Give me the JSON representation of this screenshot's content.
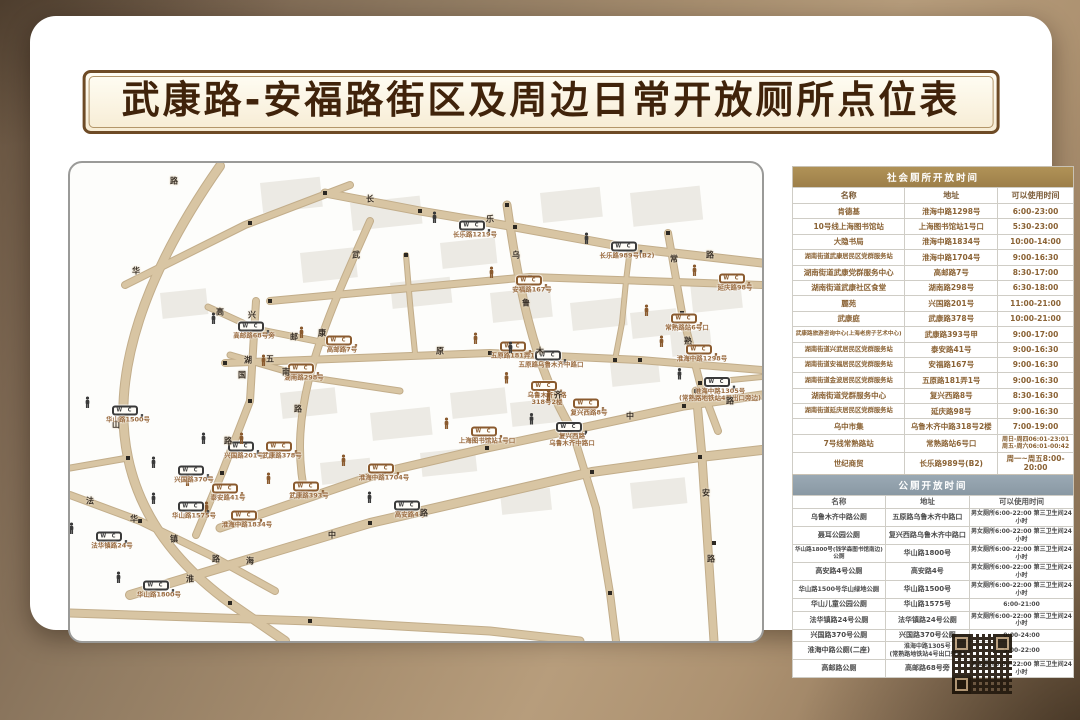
{
  "title": "武康路-安福路街区及周边日常开放厕所点位表",
  "colors": {
    "point_dark": "#3a3a3a",
    "point_brown": "#8a5a2e",
    "road_fill": "#d8c5a3",
    "road_edge": "#c2ad8a",
    "social_header_bg": "#a68a52",
    "public_header_bg": "#92a1ac"
  },
  "map": {
    "points": [
      {
        "label": "长乐路1219号",
        "x": 405,
        "y": 62,
        "color": "dark"
      },
      {
        "label": "长乐路989号(B2)",
        "x": 557,
        "y": 83,
        "color": "dark"
      },
      {
        "label": "安福路167号",
        "x": 462,
        "y": 117,
        "color": "brown"
      },
      {
        "label": "延庆路98号",
        "x": 665,
        "y": 115,
        "color": "brown"
      },
      {
        "label": "常熟路站6号口",
        "x": 617,
        "y": 155,
        "color": "brown"
      },
      {
        "label": "淮海中路1298号",
        "x": 632,
        "y": 186,
        "color": "brown"
      },
      {
        "label": "淮海中路1305号\n(常熟路地铁站4号出口旁边)",
        "x": 650,
        "y": 222,
        "color": "dark"
      },
      {
        "label": "高邮路68号旁",
        "x": 184,
        "y": 163,
        "color": "dark"
      },
      {
        "label": "高邮路7号",
        "x": 272,
        "y": 177,
        "color": "brown"
      },
      {
        "label": "湖南路298号",
        "x": 234,
        "y": 205,
        "color": "brown"
      },
      {
        "label": "华山路1500号",
        "x": 58,
        "y": 247,
        "color": "dark"
      },
      {
        "label": "五原路181弄1号",
        "x": 446,
        "y": 183,
        "color": "brown"
      },
      {
        "label": "五原路乌鲁木齐中路口",
        "x": 481,
        "y": 192,
        "color": "dark"
      },
      {
        "label": "乌鲁木齐中路\n318号2楼",
        "x": 477,
        "y": 226,
        "color": "brown"
      },
      {
        "label": "复兴西路8号",
        "x": 519,
        "y": 240,
        "color": "brown"
      },
      {
        "label": "上海图书馆站1号口",
        "x": 417,
        "y": 268,
        "color": "brown"
      },
      {
        "label": "复兴西路\n乌鲁木齐中路口",
        "x": 502,
        "y": 267,
        "color": "dark"
      },
      {
        "label": "兴国路201号",
        "x": 174,
        "y": 283,
        "color": "dark"
      },
      {
        "label": "武康路378号",
        "x": 212,
        "y": 283,
        "color": "brown"
      },
      {
        "label": "淮海中路1704号",
        "x": 314,
        "y": 305,
        "color": "brown"
      },
      {
        "label": "泰安路41号",
        "x": 158,
        "y": 325,
        "color": "brown"
      },
      {
        "label": "武康路393号",
        "x": 239,
        "y": 323,
        "color": "brown"
      },
      {
        "label": "淮海中路1834号",
        "x": 177,
        "y": 352,
        "color": "brown"
      },
      {
        "label": "高安路4号",
        "x": 340,
        "y": 342,
        "color": "dark"
      },
      {
        "label": "兴国路370号",
        "x": 124,
        "y": 307,
        "color": "dark"
      },
      {
        "label": "华山路1575号",
        "x": 124,
        "y": 343,
        "color": "dark"
      },
      {
        "label": "法华镇路24号",
        "x": 42,
        "y": 373,
        "color": "dark"
      },
      {
        "label": "华山路1800号",
        "x": 89,
        "y": 422,
        "color": "dark"
      }
    ],
    "road_labels": [
      {
        "t": "长",
        "x": 300,
        "y": 36
      },
      {
        "t": "乐",
        "x": 420,
        "y": 56
      },
      {
        "t": "路",
        "x": 640,
        "y": 92
      },
      {
        "t": "华",
        "x": 66,
        "y": 108
      },
      {
        "t": "山",
        "x": 46,
        "y": 262
      },
      {
        "t": "路",
        "x": 104,
        "y": 18
      },
      {
        "t": "兴",
        "x": 182,
        "y": 152
      },
      {
        "t": "国",
        "x": 172,
        "y": 212
      },
      {
        "t": "路",
        "x": 158,
        "y": 278
      },
      {
        "t": "武",
        "x": 286,
        "y": 92
      },
      {
        "t": "康",
        "x": 252,
        "y": 170
      },
      {
        "t": "路",
        "x": 228,
        "y": 246
      },
      {
        "t": "五",
        "x": 200,
        "y": 196
      },
      {
        "t": "原",
        "x": 370,
        "y": 188
      },
      {
        "t": "乌",
        "x": 446,
        "y": 92
      },
      {
        "t": "鲁",
        "x": 456,
        "y": 140
      },
      {
        "t": "木",
        "x": 470,
        "y": 188
      },
      {
        "t": "齐",
        "x": 488,
        "y": 232
      },
      {
        "t": "常",
        "x": 604,
        "y": 96
      },
      {
        "t": "熟",
        "x": 618,
        "y": 178
      },
      {
        "t": "安",
        "x": 636,
        "y": 330
      },
      {
        "t": "路",
        "x": 641,
        "y": 396
      },
      {
        "t": "中",
        "x": 560,
        "y": 253
      },
      {
        "t": "路",
        "x": 660,
        "y": 238
      },
      {
        "t": "湖",
        "x": 178,
        "y": 197
      },
      {
        "t": "南",
        "x": 216,
        "y": 209
      },
      {
        "t": "法",
        "x": 20,
        "y": 338
      },
      {
        "t": "华",
        "x": 64,
        "y": 356
      },
      {
        "t": "镇",
        "x": 104,
        "y": 376
      },
      {
        "t": "路",
        "x": 146,
        "y": 396
      },
      {
        "t": "高",
        "x": 150,
        "y": 149
      },
      {
        "t": "邮",
        "x": 224,
        "y": 174
      },
      {
        "t": "淮",
        "x": 120,
        "y": 416
      },
      {
        "t": "海",
        "x": 180,
        "y": 398
      },
      {
        "t": "中",
        "x": 262,
        "y": 372
      },
      {
        "t": "路",
        "x": 354,
        "y": 350
      }
    ]
  },
  "social_table": {
    "title": "社会厕所开放时间",
    "columns": [
      "名称",
      "地址",
      "可以使用时间"
    ],
    "rows": [
      [
        "肯德基",
        "淮海中路1298号",
        "6:00-23:00"
      ],
      [
        "10号线上海图书馆站",
        "上海图书馆站1号口",
        "5:30-23:00"
      ],
      [
        "大隐书局",
        "淮海中路1834号",
        "10:00-14:00"
      ],
      [
        "湖南街道武康居民区党群服务站",
        "淮海中路1704号",
        "9:00-16:30"
      ],
      [
        "湖南街道武康党群服务中心",
        "高邮路7号",
        "8:30-17:00"
      ],
      [
        "湖南街道武康社区食堂",
        "湖南路298号",
        "6:30-18:00"
      ],
      [
        "麗苑",
        "兴国路201号",
        "11:00-21:00"
      ],
      [
        "武康庭",
        "武康路378号",
        "10:00-21:00"
      ],
      [
        "武康路旅游咨询中心(上海老房子艺术中心)",
        "武康路393号甲",
        "9:00-17:00"
      ],
      [
        "湖南街道兴武居民区党群服务站",
        "泰安路41号",
        "9:00-16:30"
      ],
      [
        "湖南街道安福居民区党群服务站",
        "安福路167号",
        "9:00-16:30"
      ],
      [
        "湖南街道金波居民区党群服务站",
        "五原路181弄1号",
        "9:00-16:30"
      ],
      [
        "湖南街道党群服务中心",
        "复兴西路8号",
        "8:30-16:30"
      ],
      [
        "湖南街道延庆居民区党群服务站",
        "延庆路98号",
        "9:00-16:30"
      ],
      [
        "乌中市集",
        "乌鲁木齐中路318号2楼",
        "7:00-19:00"
      ],
      [
        "7号线常熟路站",
        "常熟路站6号口",
        "周日-周四06:01-23:01\n周五-周六06:01-00:42"
      ],
      [
        "世纪商贸",
        "长乐路989号(B2)",
        "周一~周五8:00-20:00"
      ],
      [
        "长鑫大厦",
        "长乐路1219号",
        "周一~周五8:30-17:00"
      ]
    ]
  },
  "public_table": {
    "title": "公厕开放时间",
    "columns": [
      "名称",
      "地址",
      "可以使用时间"
    ],
    "rows": [
      [
        "乌鲁木齐中路公厕",
        "五原路乌鲁木齐中路口",
        "男女厕所6:00-22:00 第三卫生间24小时"
      ],
      [
        "聂耳公园公厕",
        "复兴西路乌鲁木齐中路口",
        "男女厕所6:00-22:00 第三卫生间24小时"
      ],
      [
        "华山路1800号(钱学森图书馆南边)公厕",
        "华山路1800号",
        "男女厕所6:00-22:00 第三卫生间24小时"
      ],
      [
        "高安路4号公厕",
        "高安路4号",
        "男女厕所6:00-22:00 第三卫生间24小时"
      ],
      [
        "华山路1500号华山绿地公厕",
        "华山路1500号",
        "男女厕所6:00-22:00 第三卫生间24小时"
      ],
      [
        "华山儿童公园公厕",
        "华山路1575号",
        "6:00-21:00"
      ],
      [
        "法华镇路24号公厕",
        "法华镇路24号公厕",
        "男女厕所6:00-22:00 第三卫生间24小时"
      ],
      [
        "兴国路370号公厕",
        "兴国路370号公厕",
        "0:00-24:00"
      ],
      [
        "淮海中路公厕(二座)",
        "淮海中路1305号\n(常熟路地铁站4号出口旁边)",
        "5:00-22:00"
      ],
      [
        "高邮路公厕",
        "高邮路68号旁",
        "男女厕所6:00-22:00 第三卫生间24小时"
      ]
    ]
  }
}
